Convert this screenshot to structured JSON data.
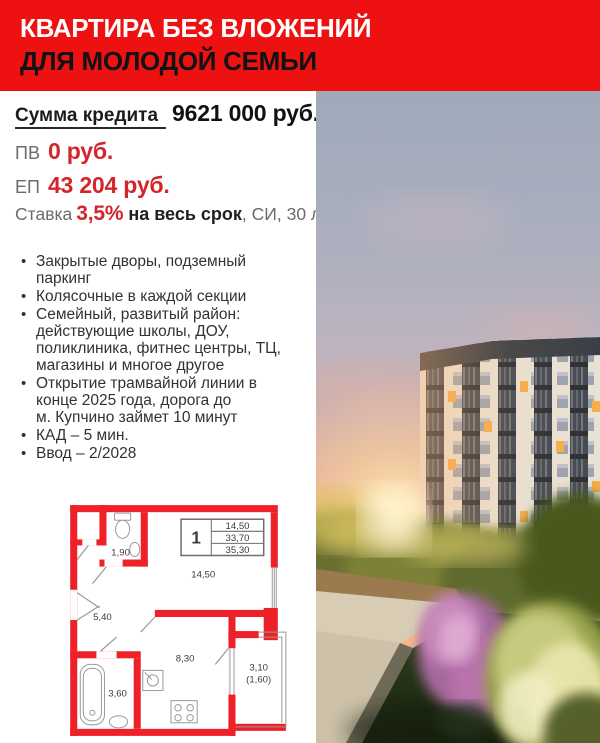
{
  "banner": {
    "line1": "КВАРТИРА БЕЗ ВЛОЖЕНИЙ",
    "line2": "ДЛЯ МОЛОДОЙ СЕМЬИ"
  },
  "finance": {
    "credit_label": "Сумма кредита",
    "credit_value": "9621 000 руб.",
    "downpayment_label": "ПВ",
    "downpayment_value": "0 руб.",
    "monthly_label": "ЕП",
    "monthly_value": "43 204 руб.",
    "rate_label": "Ставка",
    "rate_value": "3,5%",
    "rate_term": "на весь срок",
    "rate_suffix": ", СИ, 30 лет"
  },
  "features": [
    "Закрытые дворы, подземный\nпаркинг",
    "Колясочные в каждой секции",
    "Семейный, развитый район:\nдействующие школы, ДОУ,\nполиклиника, фитнес центры, ТЦ,\nмагазины и многое другое",
    "Открытие трамвайной линии в\nконце 2025 года, дорога до\nм. Купчино займет 10 минут",
    "КАД – 5 мин.",
    "Ввод – 2/2028"
  ],
  "floorplan": {
    "legend": {
      "rooms": "1",
      "area1": "14,50",
      "area2": "33,70",
      "area3": "35,30"
    },
    "labels": {
      "wc": "1,90",
      "hall": "5,40",
      "living": "14,50",
      "bath": "3,60",
      "kitchen": "8,30",
      "balcony": "3,10",
      "balcony_coef": "(1,60)"
    }
  },
  "colors": {
    "banner_red": "#ee1111",
    "accent_red": "#d2262c",
    "plan_wall_red": "#ee2028"
  }
}
